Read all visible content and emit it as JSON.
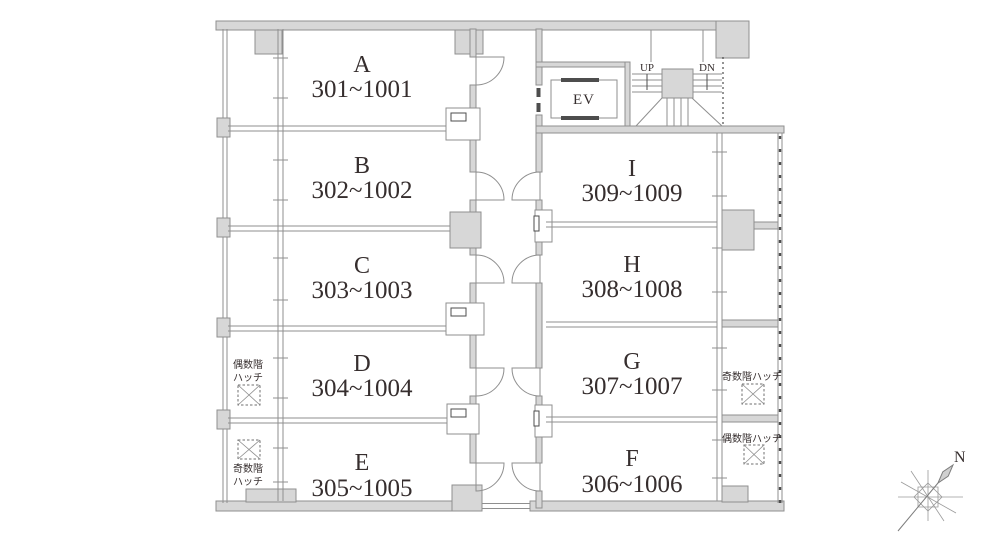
{
  "colors": {
    "background": "#ffffff",
    "wall_fill": "#d7d7d7",
    "wall_stroke": "#8f8f8f",
    "line": "#8f8f8f",
    "dark_accent": "#4d4d4d",
    "text": "#362e2e"
  },
  "units": {
    "a": {
      "label": "A",
      "rooms": "301~1001"
    },
    "b": {
      "label": "B",
      "rooms": "302~1002"
    },
    "c": {
      "label": "C",
      "rooms": "303~1003"
    },
    "d": {
      "label": "D",
      "rooms": "304~1004"
    },
    "e": {
      "label": "E",
      "rooms": "305~1005"
    },
    "f": {
      "label": "F",
      "rooms": "306~1006"
    },
    "g": {
      "label": "G",
      "rooms": "307~1007"
    },
    "h": {
      "label": "H",
      "rooms": "308~1008"
    },
    "i": {
      "label": "I",
      "rooms": "309~1009"
    }
  },
  "elevator": {
    "label": "EV"
  },
  "stairs": {
    "up": "UP",
    "down": "DN"
  },
  "hatches": {
    "left_even": {
      "line1": "偶数階",
      "line2": "ハッチ"
    },
    "left_odd": {
      "line1": "奇数階",
      "line2": "ハッチ"
    },
    "right_odd": {
      "label": "奇数階ハッチ"
    },
    "right_even": {
      "label": "偶数階ハッチ"
    }
  },
  "compass": {
    "north": "N"
  }
}
